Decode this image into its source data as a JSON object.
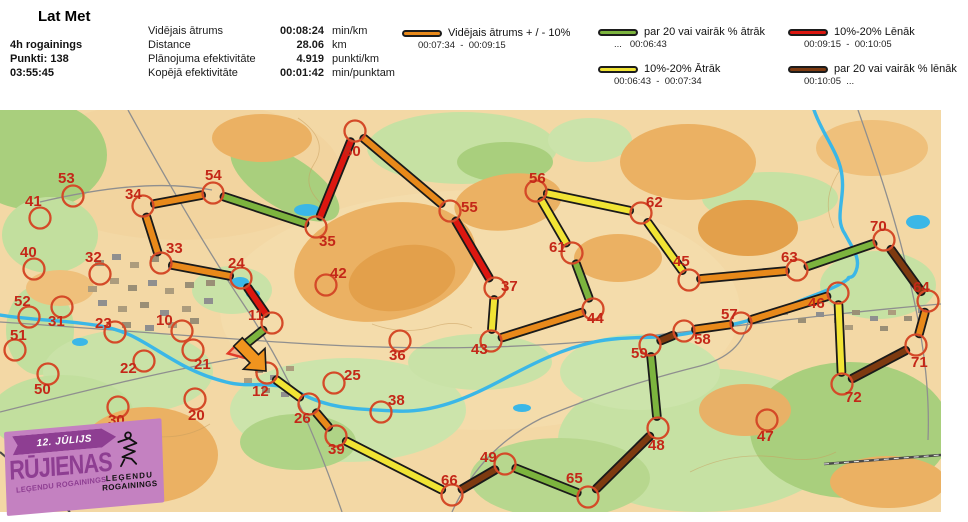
{
  "header": {
    "title": "Lat Met",
    "left": [
      "4h rogainings",
      "Punkti: 138",
      "03:55:45"
    ],
    "stats": [
      {
        "label": "Vidējais ātrums",
        "value": "00:08:24",
        "unit": "min/km"
      },
      {
        "label": "Distance",
        "value": "28.06",
        "unit": "km"
      },
      {
        "label": "Plānojuma efektivitāte",
        "value": "4.919",
        "unit": "punkti/km"
      },
      {
        "label": "Kopējā efektivitāte",
        "value": "00:01:42",
        "unit": "min/punktam"
      }
    ]
  },
  "palette": {
    "orange": "#E8891A",
    "green": "#7CB43E",
    "yellow": "#F1E434",
    "red": "#DC1710",
    "brown": "#7E3A10"
  },
  "legend": {
    "items": [
      {
        "id": "avg",
        "color_key": "orange",
        "label": "Vidējais ātrums + / - 10%",
        "range": "00:07:34  -  00:09:15"
      },
      {
        "id": "fast20",
        "color_key": "green",
        "label": "par 20 vai vairāk % ātrāk",
        "range": "...   00:06:43"
      },
      {
        "id": "fast10",
        "color_key": "yellow",
        "label": "10%-20% Ātrāk",
        "range": "00:06:43  -  00:07:34"
      },
      {
        "id": "slow10",
        "color_key": "red",
        "label": "10%-20% Lēnāk",
        "range": "00:09:15  -  00:10:05"
      },
      {
        "id": "slow20",
        "color_key": "brown",
        "label": "par 20 vai vairāk % lēnāk",
        "range": "00:10:05  ..."
      }
    ]
  },
  "logo": {
    "date": "12. JŪLIJS",
    "title": "RŪJIENAS",
    "subtitle": "LEĢENDU ROGAININGS",
    "brand_top": "LEĢENDU",
    "brand_bottom": "ROGAININGS",
    "bg_color": "#C481C1",
    "accent_color": "#8E3E92"
  },
  "map": {
    "circle_color": "#D44A28",
    "label_color": "#C42718",
    "controls": [
      {
        "id": "34",
        "x": 143,
        "y": 96,
        "lx": 125,
        "ly": 89
      },
      {
        "id": "54",
        "x": 213,
        "y": 83,
        "lx": 205,
        "ly": 70
      },
      {
        "id": "33",
        "x": 161,
        "y": 153,
        "lx": 166,
        "ly": 143
      },
      {
        "id": "24",
        "x": 241,
        "y": 168,
        "lx": 228,
        "ly": 158
      },
      {
        "id": "11",
        "x": 272,
        "y": 213,
        "lx": 248,
        "ly": 210
      },
      {
        "id": "12",
        "x": 267,
        "y": 263,
        "lx": 252,
        "ly": 286
      },
      {
        "id": "26",
        "x": 309,
        "y": 294,
        "lx": 294,
        "ly": 313
      },
      {
        "id": "39",
        "x": 336,
        "y": 326,
        "lx": 328,
        "ly": 344
      },
      {
        "id": "66",
        "x": 452,
        "y": 385,
        "lx": 441,
        "ly": 375
      },
      {
        "id": "49",
        "x": 505,
        "y": 354,
        "lx": 480,
        "ly": 352
      },
      {
        "id": "65",
        "x": 588,
        "y": 387,
        "lx": 566,
        "ly": 373
      },
      {
        "id": "48",
        "x": 658,
        "y": 318,
        "lx": 648,
        "ly": 340
      },
      {
        "id": "59",
        "x": 650,
        "y": 235,
        "lx": 631,
        "ly": 248
      },
      {
        "id": "58",
        "x": 684,
        "y": 221,
        "lx": 694,
        "ly": 234
      },
      {
        "id": "57",
        "x": 741,
        "y": 213,
        "lx": 721,
        "ly": 209
      },
      {
        "id": "46",
        "x": 838,
        "y": 183,
        "lx": 808,
        "ly": 198
      },
      {
        "id": "72",
        "x": 842,
        "y": 274,
        "lx": 845,
        "ly": 292
      },
      {
        "id": "71",
        "x": 916,
        "y": 235,
        "lx": 911,
        "ly": 257
      },
      {
        "id": "64",
        "x": 928,
        "y": 191,
        "lx": 913,
        "ly": 182
      },
      {
        "id": "70",
        "x": 884,
        "y": 130,
        "lx": 870,
        "ly": 121
      },
      {
        "id": "63",
        "x": 797,
        "y": 160,
        "lx": 781,
        "ly": 152
      },
      {
        "id": "45",
        "x": 689,
        "y": 170,
        "lx": 673,
        "ly": 156
      },
      {
        "id": "62",
        "x": 641,
        "y": 103,
        "lx": 646,
        "ly": 97
      },
      {
        "id": "56",
        "x": 536,
        "y": 81,
        "lx": 529,
        "ly": 73
      },
      {
        "id": "61",
        "x": 572,
        "y": 143,
        "lx": 549,
        "ly": 142
      },
      {
        "id": "44",
        "x": 593,
        "y": 199,
        "lx": 587,
        "ly": 213
      },
      {
        "id": "43",
        "x": 491,
        "y": 231,
        "lx": 471,
        "ly": 244
      },
      {
        "id": "37",
        "x": 495,
        "y": 178,
        "lx": 501,
        "ly": 181
      },
      {
        "id": "55",
        "x": 450,
        "y": 101,
        "lx": 461,
        "ly": 102
      },
      {
        "id": "60",
        "x": 355,
        "y": 21,
        "lx": 344,
        "ly": 46
      },
      {
        "id": "35",
        "x": 316,
        "y": 117,
        "lx": 319,
        "ly": 136
      },
      {
        "id": "53",
        "x": 73,
        "y": 86,
        "lx": 58,
        "ly": 73
      },
      {
        "id": "41",
        "x": 40,
        "y": 108,
        "lx": 25,
        "ly": 96
      },
      {
        "id": "40",
        "x": 34,
        "y": 159,
        "lx": 20,
        "ly": 147
      },
      {
        "id": "32",
        "x": 100,
        "y": 164,
        "lx": 85,
        "ly": 152
      },
      {
        "id": "52",
        "x": 29,
        "y": 207,
        "lx": 14,
        "ly": 196
      },
      {
        "id": "31",
        "x": 62,
        "y": 197,
        "lx": 48,
        "ly": 216
      },
      {
        "id": "23",
        "x": 115,
        "y": 222,
        "lx": 95,
        "ly": 218
      },
      {
        "id": "10",
        "x": 182,
        "y": 221,
        "lx": 156,
        "ly": 215
      },
      {
        "id": "51",
        "x": 15,
        "y": 240,
        "lx": 10,
        "ly": 230
      },
      {
        "id": "50",
        "x": 48,
        "y": 264,
        "lx": 34,
        "ly": 284
      },
      {
        "id": "22",
        "x": 144,
        "y": 251,
        "lx": 120,
        "ly": 263
      },
      {
        "id": "30",
        "x": 118,
        "y": 297,
        "lx": 108,
        "ly": 315
      },
      {
        "id": "21",
        "x": 193,
        "y": 240,
        "lx": 194,
        "ly": 259
      },
      {
        "id": "20",
        "x": 195,
        "y": 289,
        "lx": 188,
        "ly": 310
      },
      {
        "id": "25",
        "x": 334,
        "y": 273,
        "lx": 344,
        "ly": 270
      },
      {
        "id": "36",
        "x": 400,
        "y": 231,
        "lx": 389,
        "ly": 250
      },
      {
        "id": "38",
        "x": 381,
        "y": 302,
        "lx": 388,
        "ly": 295
      },
      {
        "id": "42",
        "x": 326,
        "y": 175,
        "lx": 330,
        "ly": 168
      },
      {
        "id": "47",
        "x": 767,
        "y": 310,
        "lx": 757,
        "ly": 331
      }
    ],
    "segments": [
      {
        "from": "34",
        "to": "54",
        "speed": "orange"
      },
      {
        "from": "54",
        "to": "35",
        "speed": "green"
      },
      {
        "from": "35",
        "to": "60",
        "speed": "red"
      },
      {
        "from": "60",
        "to": "55",
        "speed": "orange"
      },
      {
        "from": "55",
        "to": "37",
        "speed": "red"
      },
      {
        "from": "37",
        "to": "43",
        "speed": "yellow"
      },
      {
        "from": "43",
        "to": "44",
        "speed": "orange"
      },
      {
        "from": "44",
        "to": "61",
        "speed": "green"
      },
      {
        "from": "61",
        "to": "56",
        "speed": "yellow"
      },
      {
        "from": "56",
        "to": "62",
        "speed": "yellow"
      },
      {
        "from": "62",
        "to": "45",
        "speed": "yellow"
      },
      {
        "from": "45",
        "to": "63",
        "speed": "orange"
      },
      {
        "from": "63",
        "to": "70",
        "speed": "green"
      },
      {
        "from": "70",
        "to": "64",
        "speed": "brown"
      },
      {
        "from": "64",
        "to": "71",
        "speed": "orange"
      },
      {
        "from": "71",
        "to": "72",
        "speed": "brown"
      },
      {
        "from": "72",
        "to": "46",
        "speed": "yellow"
      },
      {
        "from": "46",
        "to": "57",
        "speed": "orange"
      },
      {
        "from": "57",
        "to": "58",
        "speed": "orange"
      },
      {
        "from": "58",
        "to": "59",
        "speed": "brown"
      },
      {
        "from": "59",
        "to": "48",
        "speed": "green"
      },
      {
        "from": "48",
        "to": "65",
        "speed": "brown"
      },
      {
        "from": "65",
        "to": "49",
        "speed": "green"
      },
      {
        "from": "49",
        "to": "66",
        "speed": "brown"
      },
      {
        "from": "66",
        "to": "39",
        "speed": "yellow"
      },
      {
        "from": "39",
        "to": "26",
        "speed": "orange"
      },
      {
        "from": "26",
        "to": "12",
        "speed": "yellow"
      },
      {
        "from": "34",
        "to": "33",
        "speed": "orange"
      },
      {
        "from": "33",
        "to": "24",
        "speed": "orange"
      },
      {
        "from": "24",
        "to": "11",
        "speed": "red"
      },
      {
        "from": "11",
        "to": "start",
        "speed": "green"
      }
    ],
    "start": {
      "x": 237,
      "y": 241
    },
    "arrow": {
      "tail": [
        238,
        232
      ],
      "tip": [
        266,
        261
      ]
    }
  }
}
